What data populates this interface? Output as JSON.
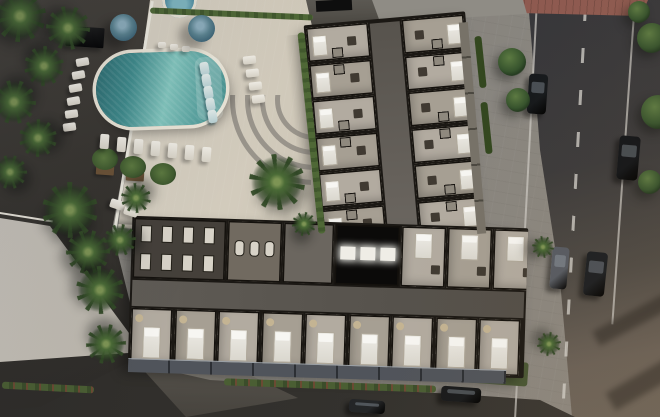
{
  "meta": {
    "description": "Aerial 3D architectural rendering of an L-shaped residential building shown as a cutaway floor plan, with a resort pool deck, palm landscaping, neighboring rooftop and surrounding streets with cars"
  },
  "pool": {
    "shape": "rounded-rectangle",
    "water_color": "#4f9a9a",
    "deck_color": "#d5cec0",
    "umbrella_color": "#3d6476",
    "umbrella_count": 2,
    "spa_count": 1,
    "in_pool_lounger_count": 5,
    "lounge_chair_count": 22,
    "in_pool_loungers": [
      [
        200,
        62
      ],
      [
        202,
        74
      ],
      [
        204,
        86
      ],
      [
        206,
        98
      ],
      [
        208,
        110
      ]
    ],
    "lounge_chairs": [
      [
        76,
        58,
        13,
        8,
        -10
      ],
      [
        72,
        71,
        13,
        8,
        -10
      ],
      [
        69,
        84,
        13,
        8,
        -10
      ],
      [
        67,
        97,
        13,
        8,
        -10
      ],
      [
        65,
        110,
        13,
        8,
        -8
      ],
      [
        63,
        123,
        13,
        8,
        -8
      ],
      [
        100,
        134,
        9,
        15,
        4
      ],
      [
        117,
        137,
        9,
        15,
        4
      ],
      [
        134,
        139,
        9,
        15,
        4
      ],
      [
        151,
        141,
        9,
        15,
        4
      ],
      [
        168,
        143,
        9,
        15,
        4
      ],
      [
        185,
        145,
        9,
        15,
        4
      ],
      [
        202,
        147,
        9,
        15,
        4
      ],
      [
        243,
        56,
        13,
        8,
        -6
      ],
      [
        246,
        69,
        13,
        8,
        -6
      ],
      [
        249,
        82,
        13,
        8,
        -6
      ],
      [
        252,
        95,
        13,
        8,
        -6
      ],
      [
        158,
        42,
        8,
        6,
        0
      ],
      [
        170,
        44,
        8,
        6,
        0
      ],
      [
        182,
        46,
        8,
        6,
        0
      ],
      [
        110,
        200,
        14,
        9,
        18
      ],
      [
        124,
        207,
        14,
        9,
        18
      ]
    ]
  },
  "building": {
    "wall_color": "#1b1814",
    "floor_color": "#b2aba0",
    "right_wing": {
      "unit_rows": 6,
      "columns": 2
    },
    "bottom_wing": {
      "top_cells": [
        "gym",
        "spa",
        "lobby",
        "elevator-core",
        "unit",
        "unit",
        "unit"
      ],
      "bottom_units": 9
    },
    "elevator_lights": 3,
    "amenities": [
      "gym",
      "spa",
      "lobby",
      "elevator-core"
    ]
  },
  "landscape": {
    "hedge_color": "#4c6434",
    "lawn_color": "#55653e",
    "palms": [
      [
        20,
        16,
        26
      ],
      [
        68,
        28,
        22
      ],
      [
        44,
        66,
        20
      ],
      [
        14,
        102,
        22
      ],
      [
        38,
        138,
        19
      ],
      [
        10,
        172,
        17
      ],
      [
        70,
        210,
        28
      ],
      [
        88,
        252,
        22
      ],
      [
        100,
        290,
        24
      ],
      [
        106,
        344,
        20
      ],
      [
        136,
        198,
        15
      ],
      [
        120,
        240,
        16
      ],
      [
        277,
        182,
        28
      ],
      [
        304,
        224,
        12
      ],
      [
        543,
        247,
        11
      ],
      [
        549,
        344,
        12
      ]
    ],
    "trees": [
      [
        652,
        38,
        15
      ],
      [
        658,
        112,
        17
      ],
      [
        650,
        182,
        12
      ],
      [
        639,
        12,
        11
      ],
      [
        512,
        62,
        14
      ],
      [
        518,
        100,
        12
      ]
    ]
  },
  "roads": {
    "asphalt_color": "#3a3a3c",
    "sunlit_asphalt_color": "#6a6158",
    "lane_line_color": "#cfccc6",
    "crosswalk_color": "#8e5a50"
  },
  "vehicles": [
    {
      "type": "sedan",
      "color": "#16191c",
      "x": 528,
      "y": 74,
      "w": 19,
      "h": 40,
      "rot": 4
    },
    {
      "type": "sedan",
      "color": "#111418",
      "x": 618,
      "y": 136,
      "w": 21,
      "h": 44,
      "rot": 5
    },
    {
      "type": "van",
      "color": "#565b63",
      "x": 551,
      "y": 247,
      "w": 17,
      "h": 42,
      "rot": 5
    },
    {
      "type": "suv",
      "color": "#1a1d21",
      "x": 585,
      "y": 252,
      "w": 21,
      "h": 44,
      "rot": 6
    },
    {
      "type": "sedan",
      "color": "#17191b",
      "x": 441,
      "y": 387,
      "w": 40,
      "h": 15,
      "rot": 4
    },
    {
      "type": "sedan",
      "color": "#232527",
      "x": 349,
      "y": 400,
      "w": 36,
      "h": 13,
      "rot": 4
    }
  ]
}
